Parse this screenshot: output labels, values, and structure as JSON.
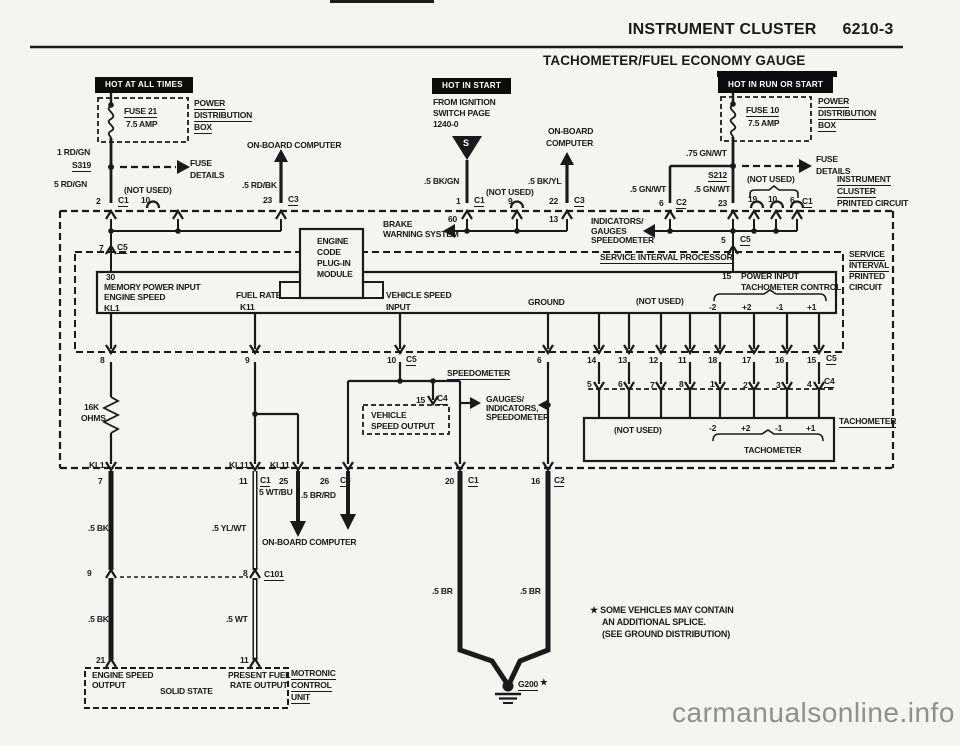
{
  "header": {
    "title": "INSTRUMENT CLUSTER",
    "page": "6210-3",
    "subtitle": "TACHOMETER/FUEL ECONOMY GAUGE"
  },
  "banners": {
    "left": "HOT AT ALL TIMES",
    "middle": "HOT IN START",
    "right": "HOT IN RUN OR START"
  },
  "colors": {
    "ink": "#1a1a1a",
    "paper": "#f5f4f0",
    "watermark_gray": "#8f8f8f"
  },
  "fl": {
    "fuse": "FUSE 21",
    "amp": "7.5 AMP",
    "pd1": "POWER",
    "pd2": "DISTRIBUTION",
    "pd3": "BOX",
    "w1": "1 RD/GN",
    "splice": "S319",
    "w2": "5 RD/GN",
    "fd1": "FUSE",
    "fd2": "DETAILS",
    "nu": "(NOT USED)",
    "obc": "ON-BOARD COMPUTER",
    "w3": ".5 RD/BK",
    "p2": "2",
    "c1": "C1",
    "p10": "10",
    "p23": "23",
    "c3": "C3"
  },
  "fm": {
    "ign1": "FROM IGNITION",
    "ign2": "SWITCH PAGE",
    "ign3": "1240-0",
    "s": "S",
    "w1": ".5 BK/GN",
    "p1": "1",
    "c1": "C1",
    "nu": "(NOT USED)",
    "p9": "9",
    "obc1": "ON-BOARD",
    "obc2": "COMPUTER",
    "w2": ".5 BK/YL",
    "p22": "22",
    "c3": "C3",
    "p60": "60",
    "p13": "13",
    "brk1": "BRAKE",
    "brk2": "WARNING SYSTEM"
  },
  "fr": {
    "fuse": "FUSE 10",
    "amp": "7.5 AMP",
    "pd1": "POWER",
    "pd2": "DISTRIBUTION",
    "pd3": "BOX",
    "w1": ".75 GN/WT",
    "splice": "S212",
    "w2": ".5 GN/WT",
    "w3": ".5 GN/WT",
    "fd1": "FUSE",
    "fd2": "DETAILS",
    "nu": "(NOT USED)",
    "p6": "6",
    "c2": "C2",
    "p23": "23",
    "p19": "19",
    "p10": "10",
    "p6b": "6",
    "c1": "C1",
    "ic1": "INSTRUMENT",
    "ic2": "CLUSTER",
    "ic3": "PRINTED CIRCUIT",
    "ind1": "INDICATORS/",
    "ind2": "GAUGES",
    "ind3": "SPEEDOMETER"
  },
  "sip": {
    "title": "SERVICE INTERVAL PROCESSOR",
    "p7": "7",
    "c5": "C5",
    "p5": "5",
    "c5b": "C5",
    "p30": "30",
    "mem": "MEMORY POWER INPUT",
    "es": "ENGINE SPEED",
    "kl1": "KL1",
    "fuel": "FUEL RATE",
    "k11": "K11",
    "vs1": "VEHICLE SPEED",
    "vs2": "INPUT",
    "gnd": "GROUND",
    "nu": "(NOT USED)",
    "p15": "15",
    "pi": "POWER INPUT",
    "tc": "TACHOMETER CONTROL",
    "m2": "-2",
    "q2": "+2",
    "m1": "-1",
    "q1": "+1",
    "sv1": "SERVICE",
    "sv2": "INTERVAL",
    "sv3": "PRINTED",
    "sv4": "CIRCUIT"
  },
  "mod": {
    "l1": "ENGINE",
    "l2": "CODE",
    "l3": "PLUG-IN",
    "l4": "MODULE"
  },
  "c5row": {
    "p8": "8",
    "p9": "9",
    "p10": "10",
    "c5": "C5",
    "p6": "6",
    "p14": "14",
    "p13": "13",
    "p12": "12",
    "p11": "11",
    "p18": "18",
    "p17": "17",
    "p16": "16",
    "p15": "15",
    "c5b": "C5"
  },
  "c4row": {
    "p5": "5",
    "p6": "6",
    "p7": "7",
    "p8": "8",
    "p1": "1",
    "p2": "2",
    "p3": "3",
    "p4": "4",
    "c4": "C4"
  },
  "mid": {
    "speedo": "SPEEDOMETER",
    "p15": "15",
    "c4": "C4",
    "vso1": "VEHICLE",
    "vso2": "SPEED OUTPUT",
    "gi1": "GAUGES/",
    "gi2": "INDICATORS,",
    "gi3": "SPEEDOMETER",
    "res1": "16K",
    "res2": "OHMS"
  },
  "tach": {
    "nu": "(NOT USED)",
    "m2": "-2",
    "q2": "+2",
    "m1": "-1",
    "q1": "+1",
    "brace": "TACHOMETER",
    "label": "TACHOMETER"
  },
  "bot": {
    "kl1": "KL1",
    "p7": "7",
    "kl11a": "KL11",
    "p11": "11",
    "c1": "C1",
    "kl11b": "KL11",
    "p25": "25",
    "p26": "26",
    "c3": "C3",
    "p20": "20",
    "c1b": "C1",
    "p16": "16",
    "c2": "C2",
    "w1": "5 WT/BU",
    "w2": ".5 BR/RD",
    "w3": ".5 BK",
    "w4": ".5 YL/WT",
    "obc": "ON-BOARD COMPUTER",
    "p9": "9",
    "p8": "8",
    "c101": "C101",
    "w5": ".5 BK",
    "w6": ".5 WT",
    "p21": "21",
    "p11b": "11",
    "mot1": "ENGINE SPEED",
    "mot2": "OUTPUT",
    "mot3": "SOLID STATE",
    "mot4": "PRESENT FUEL",
    "mot5": "RATE OUTPUT",
    "mcu1": "MOTRONIC",
    "mcu2": "CONTROL",
    "mcu3": "UNIT",
    "br1": ".5 BR",
    "br2": ".5 BR",
    "g200": "G200",
    "star": "★"
  },
  "note": {
    "l1": "★ SOME VEHICLES MAY CONTAIN",
    "l2": "AN ADDITIONAL SPLICE.",
    "l3": "(SEE GROUND DISTRIBUTION)"
  },
  "watermark": "carmanualsonline.info"
}
